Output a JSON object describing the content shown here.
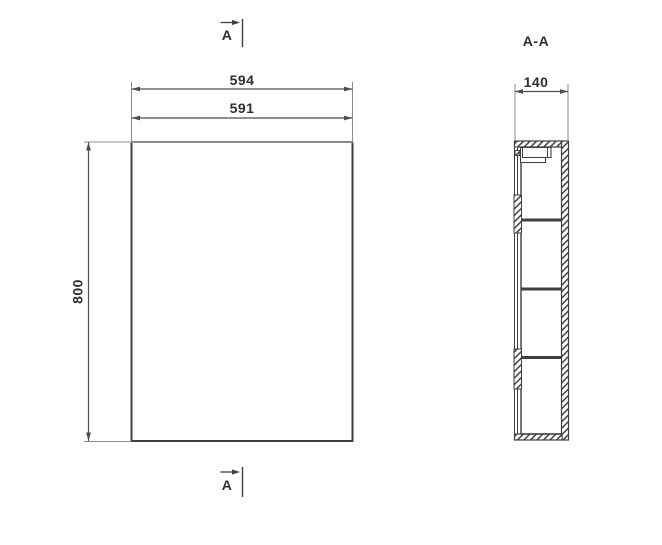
{
  "front_view": {
    "dim_outer_width": "594",
    "dim_inner_width": "591",
    "dim_height": "800"
  },
  "section_view": {
    "label": "A-A",
    "dim_depth": "140"
  },
  "cut_markers": {
    "top": "A",
    "bottom": "A"
  },
  "colors": {
    "line": "#3f3f3f",
    "dimension": "#4d4d4d",
    "extension": "#8c8c8c",
    "text": "#2f2f2f",
    "background": "#ffffff"
  }
}
